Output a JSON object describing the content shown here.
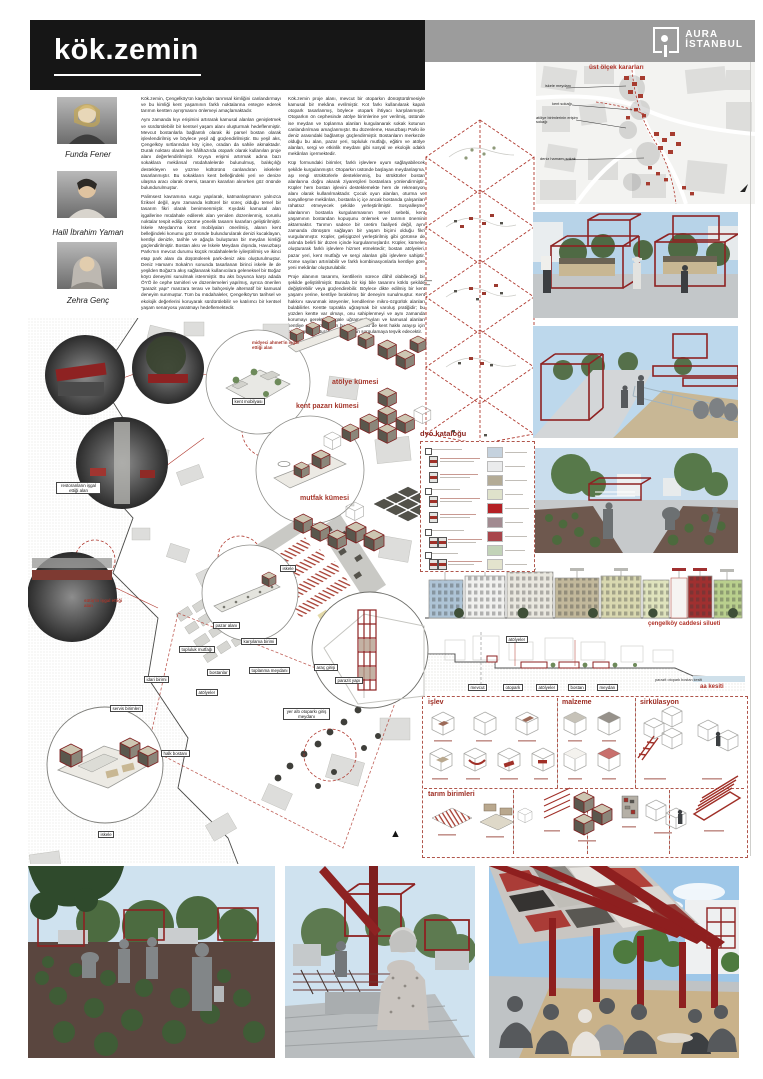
{
  "colors": {
    "accent_red": "#8e2222",
    "annotation_red": "#a5372c",
    "header_black": "#161616",
    "gray_bar": "#9c9c9c"
  },
  "header": {
    "title": "kök.zemin",
    "logo_line1": "AURA",
    "logo_line2": "İSTANBUL"
  },
  "team": {
    "members": [
      {
        "name": "Funda Fener"
      },
      {
        "name": "Halil İbrahim Yaman"
      },
      {
        "name": "Zehra Genç"
      }
    ]
  },
  "essay": {
    "col1": {
      "p1": "Kök.zemin, Çengelköy'ün kaybolan tarımsal kimliğini canlandırmayı ve bu kimliği kent yaşamının farklı noktalarına entegre ederek tarımın kentten ayrışmasını önlemeyi amaçlamaktadır.",
      "p2": "Aynı zamanda kıyı erişimini artırarak kamusal alanları genişletmek ve sürdürülebilir bir kentsel yaşam alanı oluşturmak hedeflenmiştir. Mevcut bostanlarla bağlantılı olarak iki parsel bostan olarak işlevlendirilmiş ve böylece yeşil ağ güçlendirilmiştir. Bu yeşil aks, Çengelköy sırtlarından köy içine, oradan da sahile akmaktadır. Durak noktası olarak ise hâlihazırda otopark olarak kullanılan proje alanı değerlendirilmiştir. Kıyıya erişimi artırmak adına bazı sokaklara mekânsal müdahalelerde bulunulmuş, balıkçılığı destekleyen ve yüzme kültürünü canlandıran iskeleler tasarlanmıştır. Bu sokakların kent belleğindeki yeri ve denize ulaşma aracı olarak önemi, tasarım kararları alınırken göz önünde bulundurulmuştur.",
      "p3": "Palimsest kavramına vurgu yapılarak, katmanlaşmanın yalnızca fiziksel değil, aynı zamanda kültürel bir süreç olduğu temel bir tasarım fikri olarak benimsenmiştir. Kıyıdaki kamusal alan işgallerine müdahale edilerek alan yeniden düzenlenmiş, sorunlu noktalar tespit edilip çözüme yönelik tasarım kararları geliştirilmiştir. İskele Meydanı'na kent mobilyaları önerilmiş, alanın kent belleğindeki konumu göz önünde bulundurularak denizi kucaklayan, kentliyi denizle, tarihle ve ağaçla buluşturan bir meydan kimliği güçlendirilmiştir. Bostan aksı ve İskele Meydanı dışında, Havuzbaşı Parkı'nın mevcut durumu küçük müdahalelerle iyileştirilmiş ve ikinci etap park alanı da düşünülerek park-deniz aksı oluşturulmuştur. Deniz Hamamı Sokak'ın sonunda tasarlanan birinci iskele ile de yeşilden Boğaz'a akış sağlanarak kullanıcılara geleneksel bir Boğaz köyü deneyimi sunulmak istenmiştir. Bu aks boyunca karşı adada ÖYÖ ile cephe tamirleri ve düzenlemeleri yapılmış, ayrıca önerilen \"parazit yapı\" manzara terası ve bahçesiyle alternatif bir kamusal deneyim sunmuştur. Tüm bu müdahaleler, Çengelköy'ün tarihsel ve ekolojik değerlerini koruyarak sürdürülebilir ve katılımcı bir kentsel yaşam senaryosu yaratmayı hedeflemektedir."
    },
    "col2": {
      "p1": "Kök.zemin proje alanı, mevcut bir otoparkın dönüştürülmesiyle kamusal bir mekâna evrilmiştir. Kot farkı kullanılarak kapalı otopark tasarlanmış, böylece otopark ihtiyacı karşılanmıştır. Otoparkın ön cephesinde atölye birimlerine yer verilmiş, üstünde ise meydan ve toplanma alanları kurgulanarak sokak kotunun canlandırılması amaçlanmıştır. Bu düzenleme, Havuzbaşı Parkı ile deniz arasındaki bağlantıyı güçlendirmiştir. Bostanların merkezde olduğu bu alan, pazar yeri, topluluk mutfağı, eğitim ve atölye alanları, sergi ve etkinlik meydanı gibi sosyal ve ekolojik odaklı mekânları içermektedir.",
      "p2": "Küp formundaki birimler, farklı işlevlere uyum sağlayabilecek şekilde kurgulanmıştır. Otoparkın üstünde başlayan meydanlaşma, aşı rengi strüktürlerle desteklenmiş, bu strüktürler bostan alanlarına doğru akarak ziyaretçileri bostanlara yönlendirmiştir. Küpler hem bostan işlevini desteklemekte hem de rekreasyon alanı olarak kullanılmaktadır. Çocuk oyun alanları, oturma ve sosyalleşme mekânları, bostanla iç içe ancak bostanda çalışanları rahatsız etmeyecek şekilde yerleştirilmiştir. Sosyalleşme alanlarının bostanla kurgulanmasının temel sebebi, kent yaşamının bostandan kopuşunu önlemek ve tarımın önemini aktarmaktır. Tarımın sadece bir üretim faaliyeti değil, aynı zamanda dönüşüm sağlayan bir yaşam biçimi olduğu fikri vurgulanmıştır. Küpler, gelişigüzel yerleştirilmiş gibi görünse de aslında belirli bir düzen içinde kurgulanmışlardır. Küpler, kümeler oluşturarak farklı işlevlere hizmet etmektedir; bostan atölyeleri, pazar yeri, kent mutfağı ve sergi alanları gibi işlevlere sahiptir. Küme sayıları artırılabilir ve farklı kombinasyonlarla kentliye göre yeni mekânlar oluşturulabilir.",
      "p3": "Proje alanının tasarımı, kentlilerin sürece dâhil olabileceği bir şekilde geliştirilmiştir. Burada bir kişi bile tasarımı köklü şekilde değiştirebilir veya güçlendirebilir. Böylece dikte edilmiş bir kent yaşamı yerine, kentliye bırakılmış bir deneyim sunulmuştur. Kent hakkını savunmak isteyenler, kendilerine mikro-özgürlük alanları bulabilirler. Kentte toprakla uğraşmak bir varoluş pratiğidir; bu yüzden kentte var olmayı, onu sahiplenmeyi ve aynı zamanda korumayı gerektirir. İşgale uğramış kıyıları ve kamusal alanları kentliye geri kazandıran bu proje, belki de kent hakkı arayışı için bir itici güç oluşturacak ve insanları sorgulamaya teşvik edecektir."
    }
  },
  "upper_scale": {
    "title": "üst ölçek kararları",
    "l1": "iskele meydanı",
    "l2": "kent sokağı",
    "l3": "atölye birimlerinin erişim sokağı",
    "l4": "deniz hamamı sokak"
  },
  "clusters": {
    "atolye": "atölye kümesi",
    "pazar": "kent pazarı kümesi",
    "mutfak": "mutfak kümesi"
  },
  "dyo": {
    "title": "dyo kataloğu",
    "swatches": [
      "#c5d2de",
      "#eaebec",
      "#b3ab96",
      "#dfe2cb",
      "#b42025",
      "#a18a90",
      "#a8454b",
      "#c2d3b8",
      "#e3e3cd"
    ]
  },
  "silhouette": {
    "label": "çengelköy caddesi silueti"
  },
  "section": {
    "top_tag": "atölyeler",
    "t1": "mevcut",
    "t2": "otopark",
    "t3": "atölyeler",
    "t4": "bostan",
    "t5": "meydan",
    "sublabel": "parazit otopark bostan kesiti",
    "label": "aa kesiti"
  },
  "matrix": {
    "islev": "işlev",
    "malzeme": "malzeme",
    "sirkulasyon": "sirkülasyon",
    "tarim": "tarım birimleri"
  },
  "plan": {
    "labels": [
      {
        "text": "kent mobilyası"
      },
      {
        "text": "iskele"
      },
      {
        "text": "iskele"
      },
      {
        "text": "servis birimleri"
      },
      {
        "text": "idari birimi"
      },
      {
        "text": "atölyeler"
      },
      {
        "text": "halk bostanı"
      },
      {
        "text": "pazar alanı"
      },
      {
        "text": "topluluk mutfağı"
      },
      {
        "text": "bostanlar"
      },
      {
        "text": "karşılama birimi"
      },
      {
        "text": "toplanma meydanı"
      },
      {
        "text": "araç girişi"
      },
      {
        "text": "parazit yapı"
      },
      {
        "text": "yer altı otoparkı giriş meydanı"
      }
    ],
    "annotations": [
      {
        "text": "midyeci ahmet'in işgal ettiği alan"
      },
      {
        "text": "sütiş'in işgal ettiği alan"
      },
      {
        "text": "restoranların işgal ettiği alan"
      }
    ]
  },
  "compass": {
    "glyph": "▲"
  }
}
